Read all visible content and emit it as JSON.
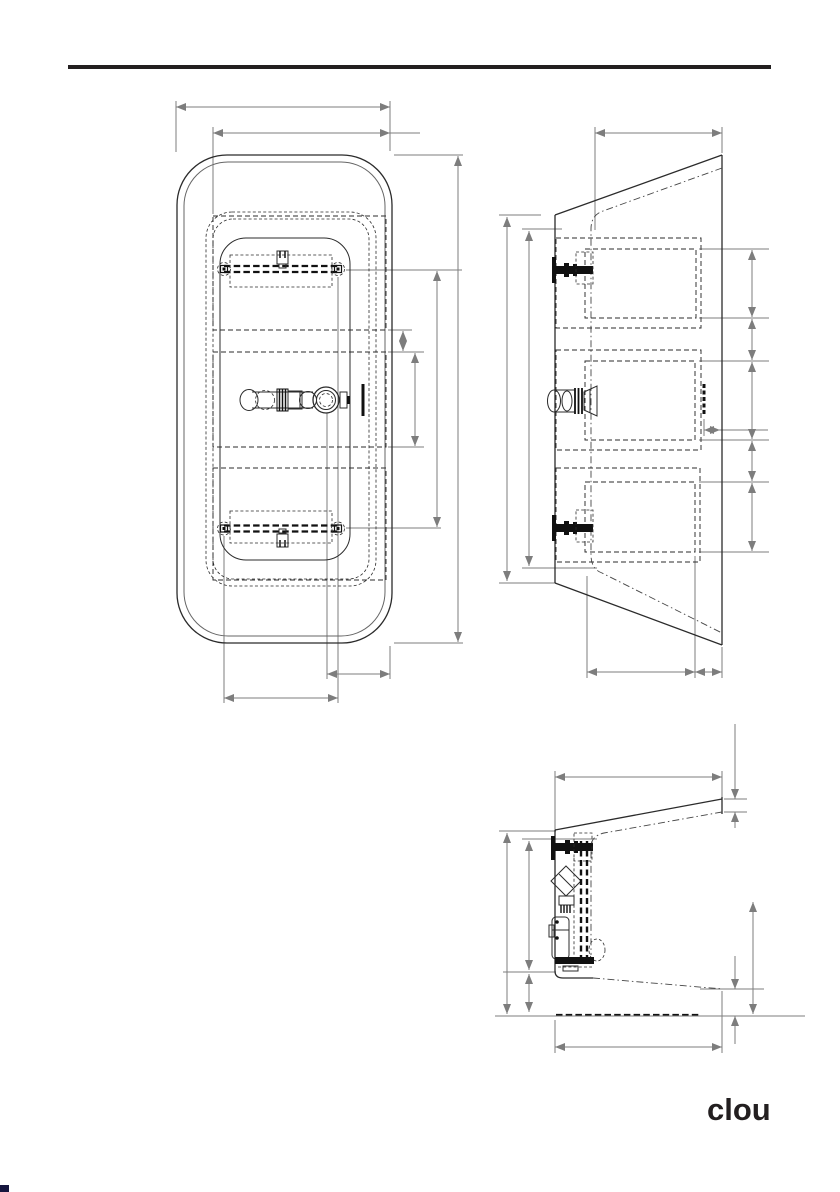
{
  "logo": {
    "text": "clou"
  },
  "colors": {
    "rule": "#231f20",
    "drawing_line": "#2b2b2b",
    "dimension_line": "#7d7d7d",
    "solid_black": "#111111",
    "corner_mark": "#16163e",
    "paper": "#ffffff"
  },
  "drawings": [
    {
      "id": "top-view"
    },
    {
      "id": "side-view"
    },
    {
      "id": "section-view"
    }
  ]
}
